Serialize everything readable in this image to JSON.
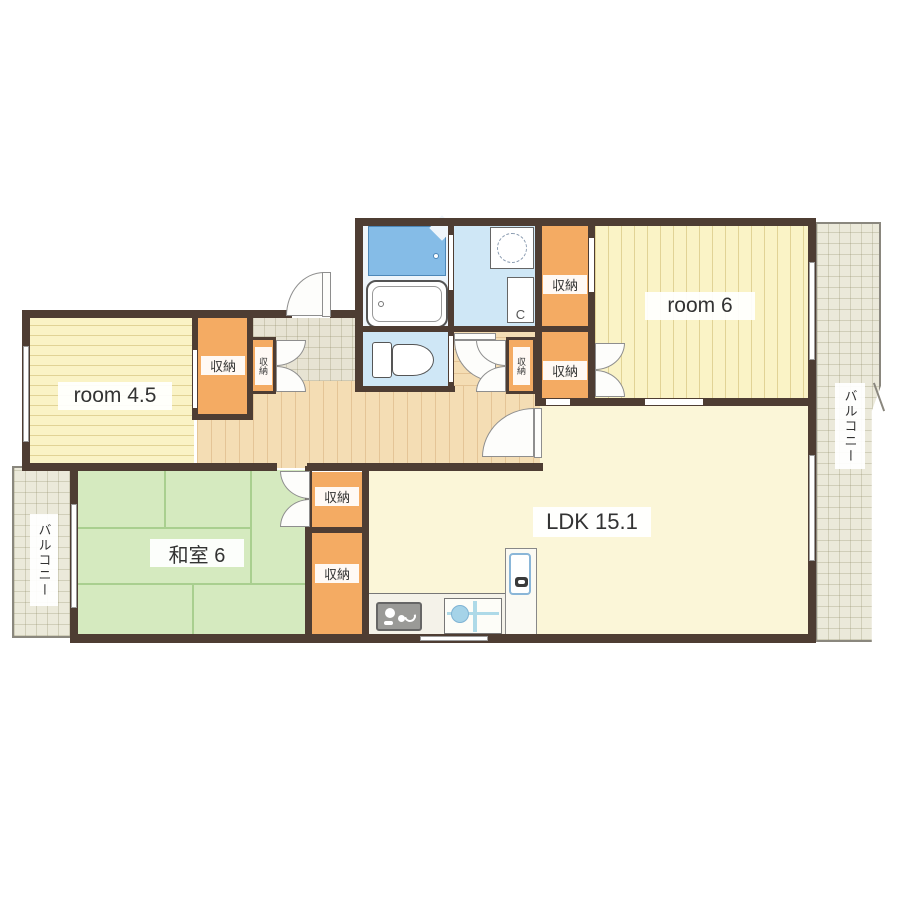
{
  "plan": {
    "rooms": {
      "room6": {
        "label": "room 6"
      },
      "room45": {
        "label": "room 4.5"
      },
      "washitsu": {
        "label": "和室 6"
      },
      "ldk": {
        "label": "LDK 15.1"
      }
    },
    "storage_label": "収納",
    "balcony_label": "バルコニー",
    "colors": {
      "wall": "#4e3d33",
      "room_yellow": "#faf3c6",
      "ldk_cream": "#fbf6d8",
      "tatami_green": "#d5eabf",
      "closet_orange": "#f4ab63",
      "hallway_wood": "#f4ddb4",
      "balcony_tile": "#ebe9da",
      "water_blue": "#cfe7f6",
      "shower_blue": "#85bce7"
    }
  }
}
